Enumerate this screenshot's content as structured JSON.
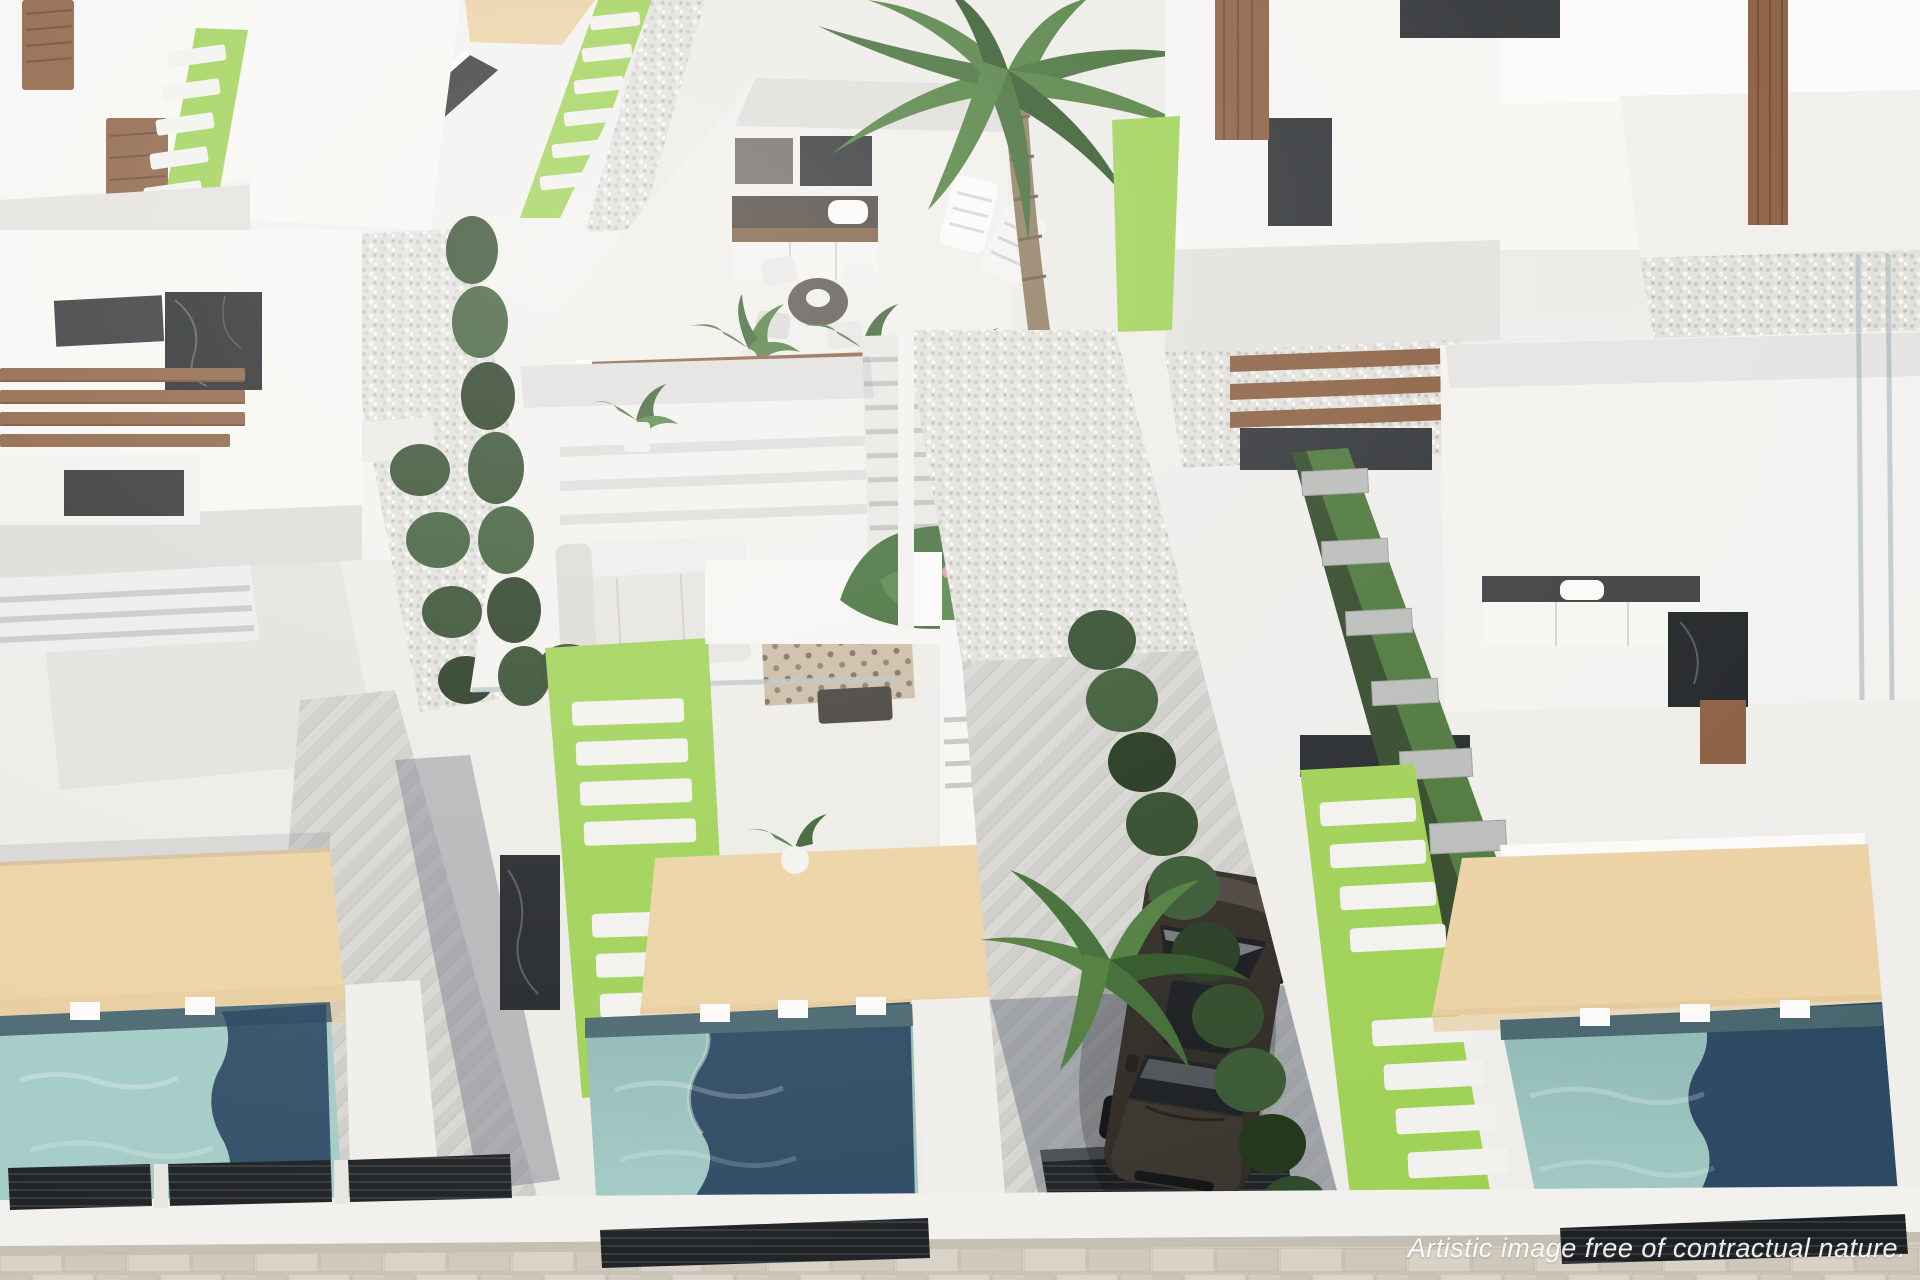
{
  "scene": {
    "title": "Aerial 3D render of a modern white villa development with private pools",
    "watermark": "Artistic image free of contractual nature.",
    "setting": "top-down aerial view, bright daylight, new-build residential resort",
    "elements": [
      "white modern villas",
      "rooftop terrace with outdoor kitchen",
      "dining set",
      "sun lounge chairs",
      "wood pergola beams",
      "black marble accents",
      "turquoise swimming pools with navy deep end",
      "beige sun decks",
      "artificial grass strips with white pavers",
      "cypress hedge rows",
      "tall palm tree",
      "gravel side yards",
      "herringbone paved driveway",
      "dark parked car",
      "stone-paved street",
      "dark slatted privacy fences"
    ]
  },
  "palette": {
    "background": "#edebe6",
    "wall_white": "#f6f5f2",
    "wall_shadow": "#d9d7d3",
    "floor_light": "#f0eeea",
    "pool_light": "#a3cbc6",
    "pool_deep": "#27425e",
    "pool_edge": "#49666f",
    "deck_beige": "#ecd2a4",
    "grass_bright": "#9ed154",
    "grass_dark": "#4c763a",
    "hedge_green": "#2d4827",
    "palm_green": "#4d7c3b",
    "wood_brown": "#8a5e40",
    "marble_black": "#212426",
    "glass_dark": "#2e3133",
    "gravel_gray": "#e2e0db",
    "paver_light": "#d8d6d2",
    "street_stone": "#d4cdc1",
    "fence_dark": "#23262a",
    "car_body": "#2e2822"
  }
}
